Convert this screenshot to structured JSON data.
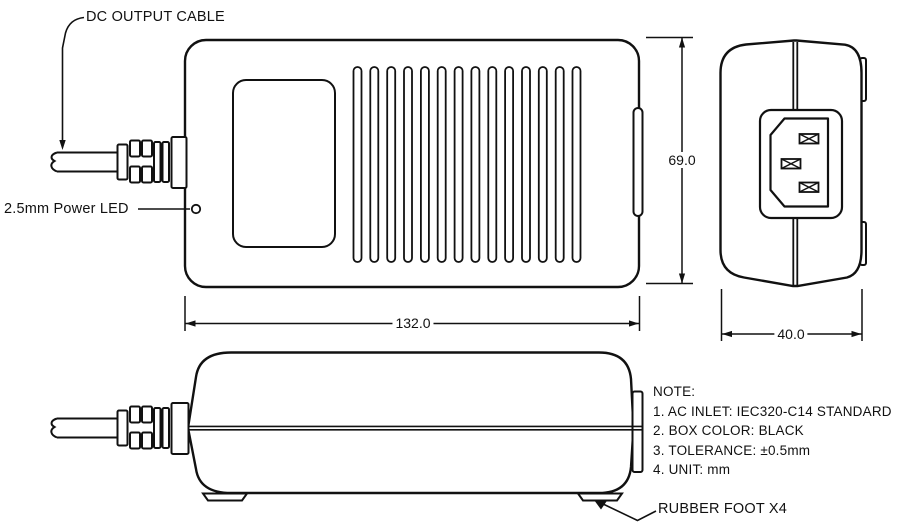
{
  "labels": {
    "dc_output_cable": "DC OUTPUT CABLE",
    "power_led": "2.5mm Power LED",
    "rubber_foot": "RUBBER FOOT X4"
  },
  "dimensions": {
    "body_height_mm": "69.0",
    "body_length_mm": "132.0",
    "body_width_mm": "40.0"
  },
  "note": {
    "title": "NOTE:",
    "lines": [
      "1. AC INLET: IEC320-C14 STANDARD",
      "2. BOX COLOR: BLACK",
      "3. TOLERANCE: ±0.5mm",
      "4. UNIT: mm"
    ]
  },
  "colors": {
    "line": "#111111",
    "background": "#ffffff"
  }
}
